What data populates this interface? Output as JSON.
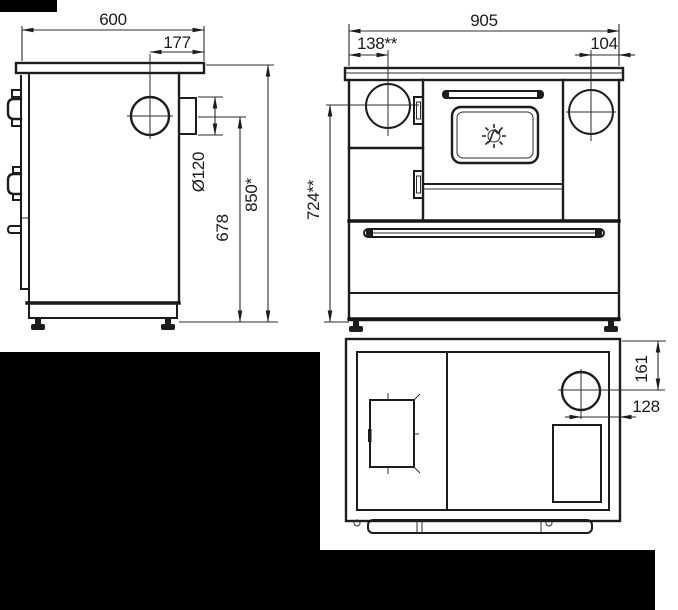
{
  "dimensions": {
    "side_width": "600",
    "flue_offset": "177",
    "flue_diameter": "Ø120",
    "flue_center_height": "678",
    "overall_height": "850*",
    "front_width": "905",
    "hotplate_offset": "138**",
    "right_hotplate_edge_offset": "104",
    "worktop_height": "724**",
    "top_flue_offset_back": "161",
    "top_flue_offset_side": "128"
  },
  "colors": {
    "line": "#1c1c1c",
    "background": "#ffffff",
    "redaction": "#000000"
  }
}
